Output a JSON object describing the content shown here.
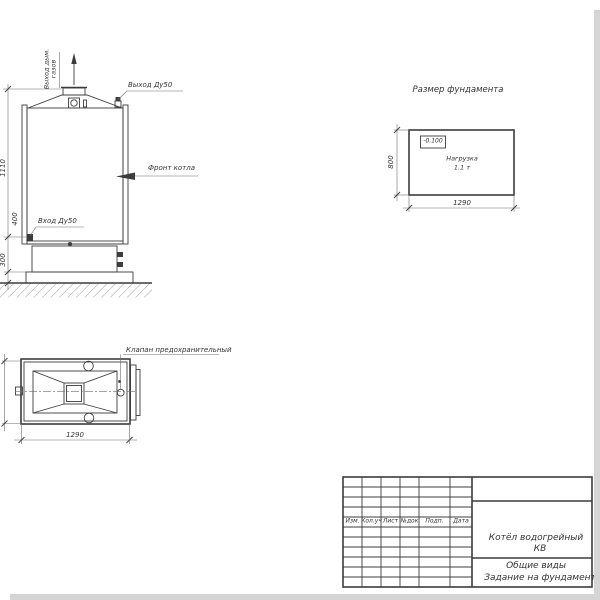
{
  "colors": {
    "ink": "#3c3c3c",
    "paper": "#ffffff"
  },
  "front_view": {
    "flue_line1": "Выход дым.",
    "flue_line2": "газов",
    "outlet_label": "Выход Ду50",
    "front_label": "Фронт котла",
    "inlet_label": "Вход Ду50",
    "dim_height": "1110",
    "dim_inlet": "400",
    "dim_base": "300"
  },
  "foundation_view": {
    "title": "Размер фундамента",
    "level_mark": "-0.100",
    "load_line1": "Нагрузка",
    "load_line2": "1.1 т",
    "dim_depth": "800",
    "dim_width": "1290"
  },
  "top_view": {
    "valve_label": "Клапан предохранительный",
    "dim_width": "1290"
  },
  "title_block": {
    "columns": [
      "Изм.",
      "Кол.уч",
      "Лист",
      "№док",
      "Подп.",
      "Дата"
    ],
    "doc_title_line1": "Котёл водогрейный",
    "doc_title_line2": "КВ",
    "doc_type_line1": "Общие виды",
    "doc_type_line2": "Задание на фундамент"
  }
}
